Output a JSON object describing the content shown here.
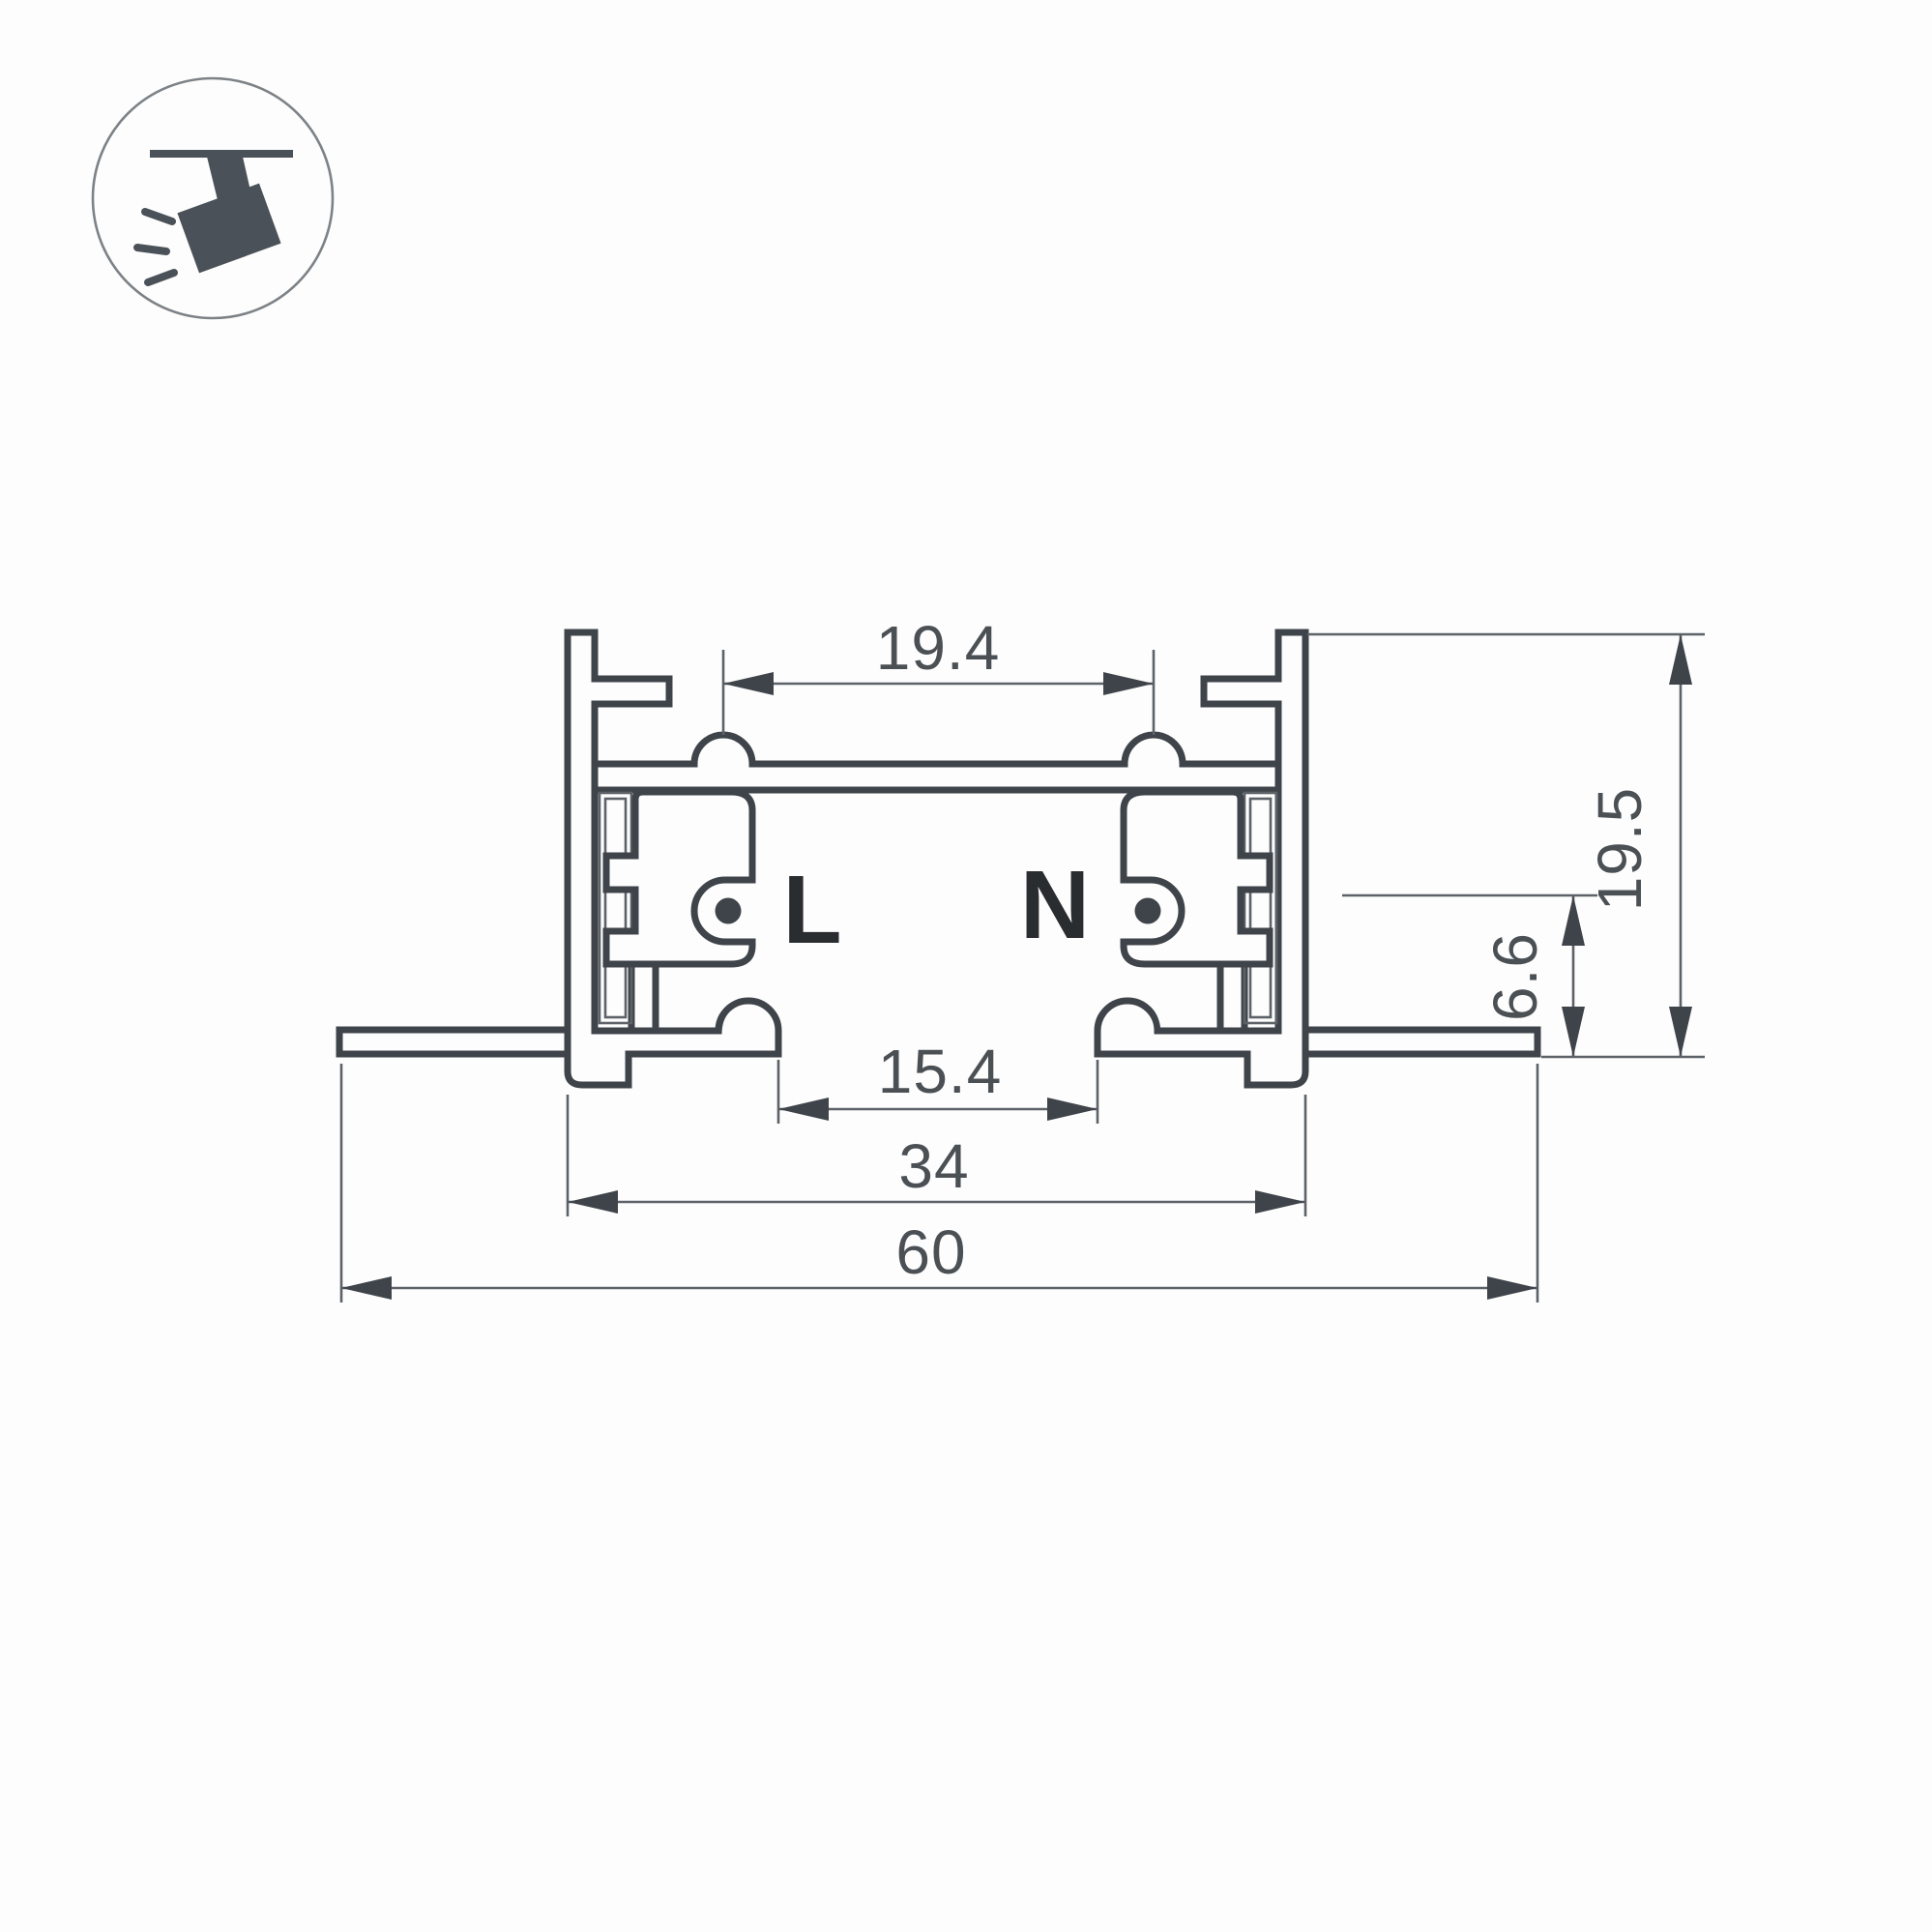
{
  "title": "Recessed track lighting profile cross-section drawing",
  "icon": {
    "name": "ceiling-track-spotlight-icon"
  },
  "labels": {
    "live": "L",
    "neutral": "N"
  },
  "dimensions": {
    "top_inner_width": "19.4",
    "overall_height": "19.5",
    "conductor_axis_height": "6.6",
    "bottom_opening_width": "15.4",
    "body_width": "34",
    "overall_width": "60"
  },
  "colors": {
    "background": "#fdfdfd",
    "profile_line": "#3f444a",
    "dimension_line": "#5d6268",
    "dimension_text": "#4b5055",
    "conductor_label": "#2a2d30",
    "icon": "#4a5158"
  }
}
